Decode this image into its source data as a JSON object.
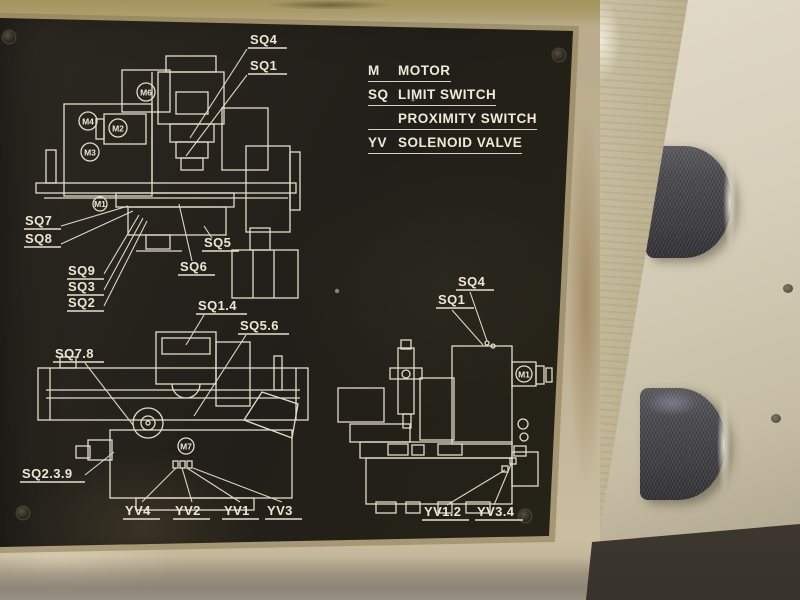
{
  "plate": {
    "legend": [
      {
        "abbr": "M",
        "name": "MOTOR"
      },
      {
        "abbr": "SQ",
        "name": "LIMIT SWITCH"
      },
      {
        "abbr": "",
        "name": "PROXIMITY SWITCH"
      },
      {
        "abbr": "YV",
        "name": "SOLENOID VALVE"
      }
    ],
    "mill": {
      "labels": {
        "sq4": "SQ4",
        "sq1": "SQ1",
        "sq7": "SQ7",
        "sq8": "SQ8",
        "sq9": "SQ9",
        "sq3": "SQ3",
        "sq2": "SQ2",
        "sq5": "SQ5",
        "sq6": "SQ6"
      },
      "motors": {
        "top": "M6",
        "left_upper": "M4",
        "left_mid": "M2",
        "left_lower": "M3",
        "table": "M1"
      }
    },
    "grinder_side": {
      "labels": {
        "sq14": "SQ1.4",
        "sq56": "SQ5.6",
        "sq78": "SQ7.8",
        "sq239": "SQ2.3.9",
        "yv4": "YV4",
        "yv2": "YV2",
        "yv1": "YV1",
        "yv3": "YV3"
      },
      "motors": {
        "base": "M7"
      }
    },
    "grinder_front": {
      "labels": {
        "sq4": "SQ4",
        "sq1": "SQ1",
        "yv12": "YV1.2",
        "yv34": "YV3.4"
      },
      "motors": {
        "side": "M1"
      }
    }
  },
  "colors": {
    "plate_black": "#24211b",
    "line_white": "#e2dcca",
    "panel_beige": "#bcae8f",
    "wall_beige": "#d7cfba",
    "knob_gray": "#454449"
  }
}
